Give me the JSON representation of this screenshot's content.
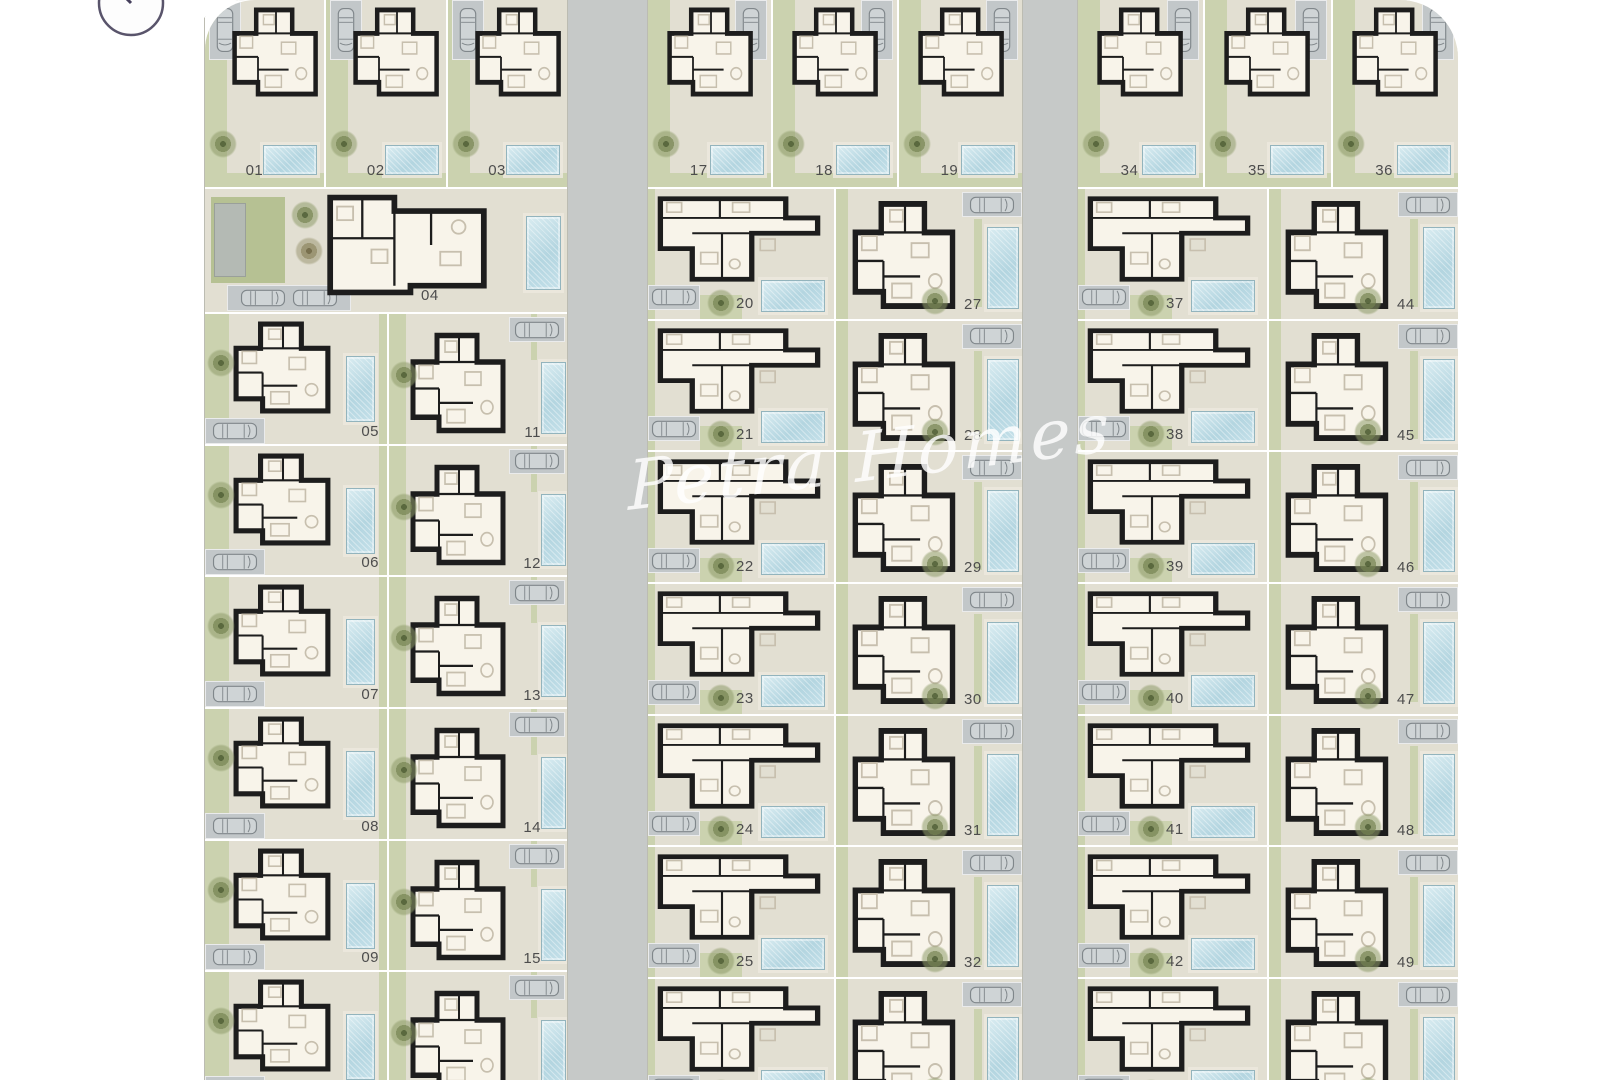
{
  "watermark": {
    "text": "Petra Homes"
  },
  "icons": {
    "compass": "compass-north",
    "car": "car-top-view",
    "tree": "tree-plan-view"
  },
  "palette": {
    "road": "#c6c9c8",
    "parcel": "#e2dfd2",
    "garden": "#cbd2af",
    "pool": "#b5d6e0",
    "wall": "#1d1d1d",
    "plot_label": "#4d4d4d",
    "watermark": "#ffffff"
  },
  "plots": {
    "left_top": [
      "01",
      "02",
      "03"
    ],
    "left_corner": [
      "04"
    ],
    "left_col_a": [
      "05",
      "06",
      "07",
      "08",
      "09",
      "10"
    ],
    "left_col_b": [
      "11",
      "12",
      "13",
      "14",
      "15"
    ],
    "mid_top": [
      "17",
      "18",
      "19"
    ],
    "mid_col_a": [
      "20",
      "21",
      "22",
      "23",
      "24",
      "25"
    ],
    "mid_col_b": [
      "27",
      "28",
      "29",
      "30",
      "31",
      "32"
    ],
    "right_top": [
      "34",
      "35",
      "36"
    ],
    "right_col_a": [
      "37",
      "38",
      "39",
      "40",
      "41",
      "42"
    ],
    "right_col_b": [
      "44",
      "45",
      "46",
      "47",
      "48",
      "49"
    ]
  }
}
